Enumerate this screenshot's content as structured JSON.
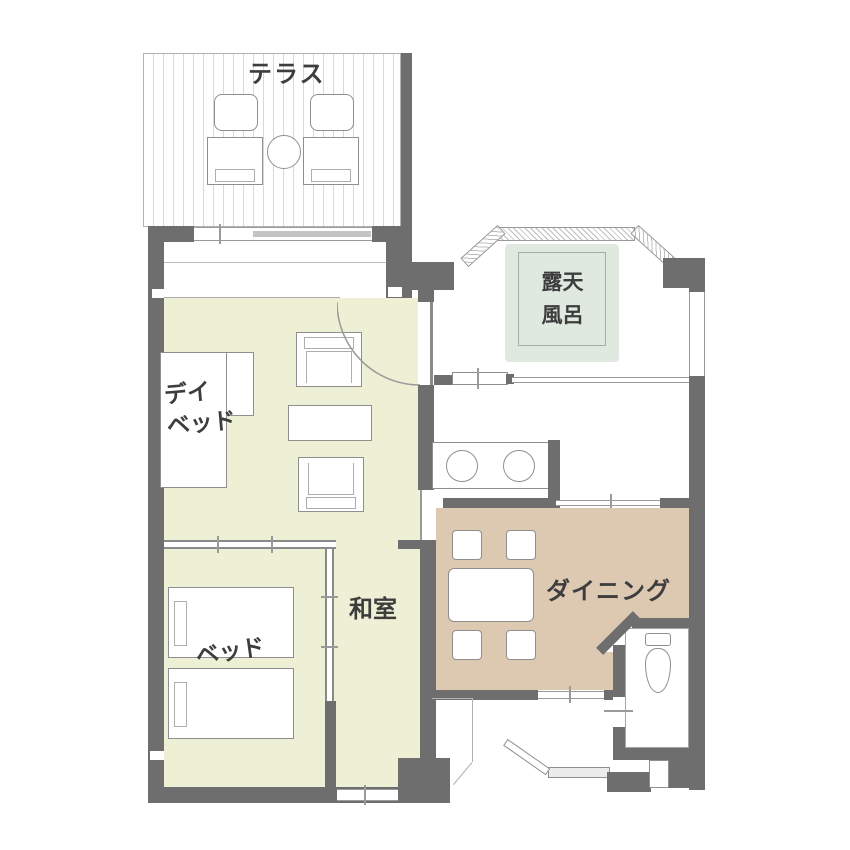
{
  "plan_title": "room-floor-plan",
  "rooms": {
    "terrace": {
      "label": "テラス"
    },
    "open_air_bath": {
      "line1": "露天",
      "line2": "風呂"
    },
    "daybed_area": {
      "line1": "デイ",
      "line2": "ベッド"
    },
    "washitsu": {
      "label": "和室"
    },
    "bedroom": {
      "label": "ベッド"
    },
    "dining": {
      "label": "ダイニング"
    }
  },
  "colors": {
    "wall": "#6e6e6e",
    "tatami_floor": "#eef0d5",
    "dining_floor": "#ddc9b1",
    "bath_tub": "#dfe9df",
    "label_text": "#3d3d3d"
  },
  "icons": [
    "terrace-chair-icon",
    "round-table-icon",
    "day-bed-icon",
    "armchair-icon",
    "low-table-icon",
    "twin-bed-icon",
    "vanity-sink-icon",
    "dining-table-icon",
    "dining-chair-icon",
    "toilet-icon",
    "entrance-door-icon",
    "door-swing-arc-icon",
    "sliding-door-icon",
    "bay-window-icon"
  ]
}
